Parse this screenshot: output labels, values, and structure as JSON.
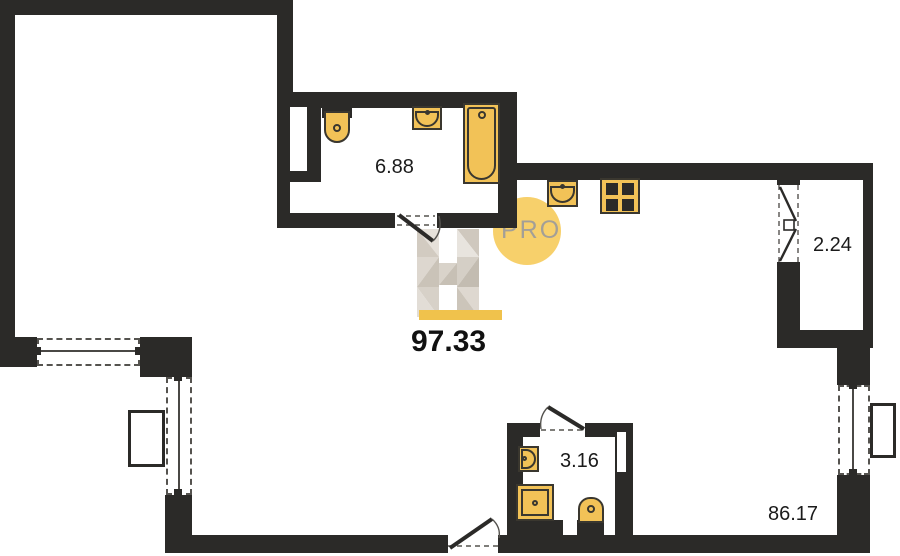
{
  "page": {
    "title": "Apartment floor plan"
  },
  "watermark": {
    "brand_letter": "H",
    "badge_text": "PRO"
  },
  "areas": {
    "bathroom_top": "6.88",
    "total": "97.33",
    "balcony": "2.24",
    "bathroom_bottom": "3.16",
    "main_room": "86.17"
  },
  "colors": {
    "wall": "#2b2a28",
    "fixture_fill": "#f2c257",
    "fixture_outline": "#3a372f",
    "watermark_circle": "#f7d06b",
    "watermark_underline": "#f0c24c",
    "watermark_text": "#a39f97",
    "background": "#ffffff"
  },
  "fixtures": {
    "bathroom_top": [
      "toilet",
      "sink",
      "bathtub"
    ],
    "kitchen": [
      "sink",
      "stove"
    ],
    "bathroom_bottom": [
      "sink",
      "shower",
      "toilet"
    ]
  }
}
